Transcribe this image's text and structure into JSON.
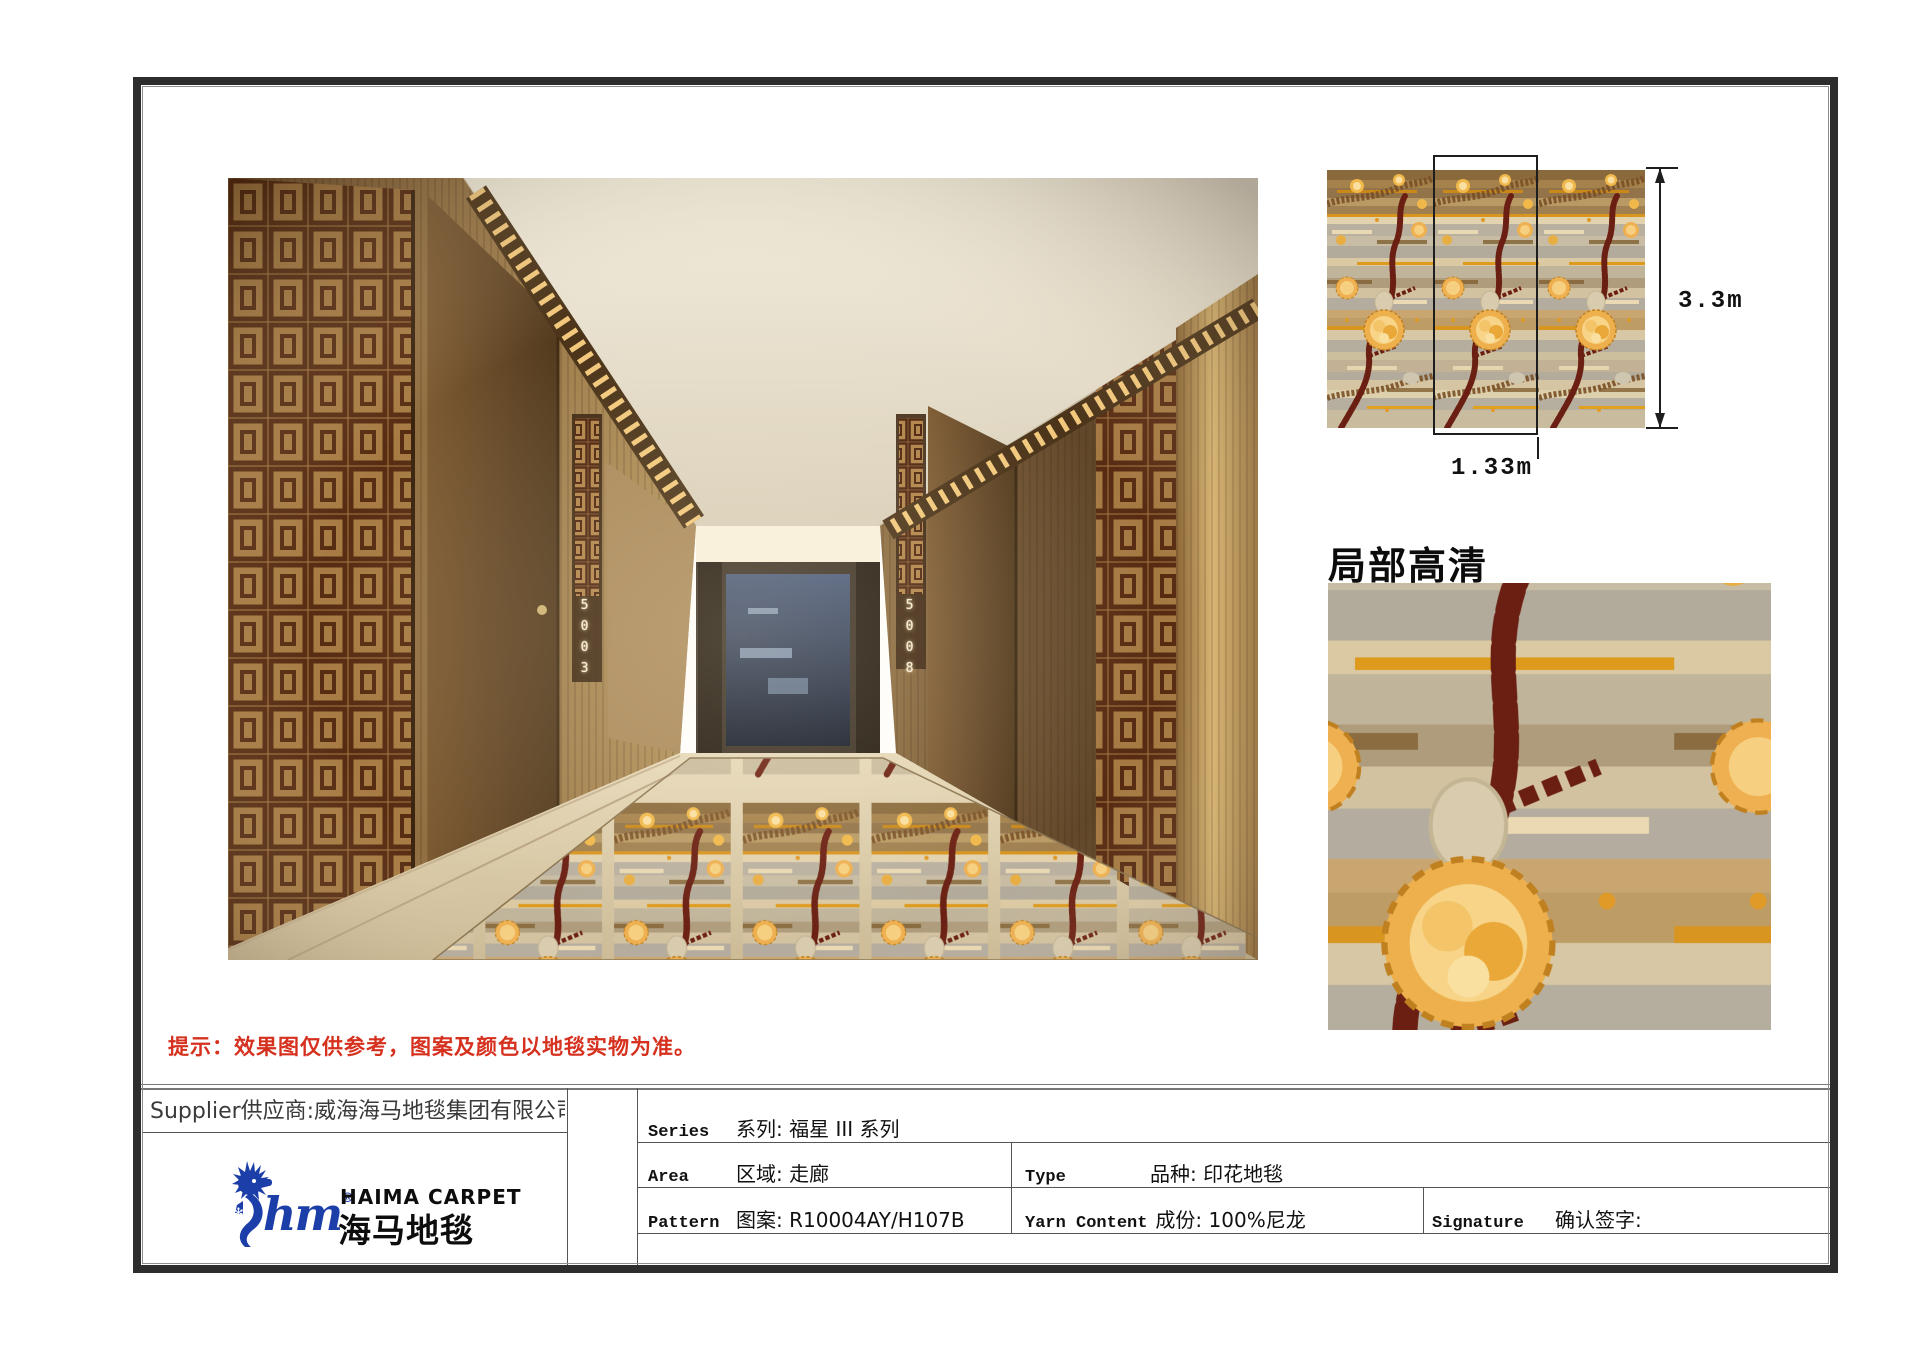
{
  "corridor": {
    "left_door_number": "5003",
    "right_door_number": "5008"
  },
  "swatch": {
    "height_label": "3.3m",
    "width_label": "1.33m"
  },
  "closeup": {
    "title": "局部高清"
  },
  "notice": {
    "text": "提示：效果图仅供参考，图案及颜色以地毯实物为准。",
    "color": "#d6301e"
  },
  "supplier": {
    "text": "Supplier供应商:威海海马地毯集团有限公司"
  },
  "logo": {
    "mark": "hm",
    "reg": "®",
    "name_en": "HAIMA CARPET",
    "name_cn": "海马地毯",
    "color": "#1c3ea8"
  },
  "table": {
    "series": {
      "en": "Series",
      "cn": "系列: 福星 III 系列"
    },
    "area": {
      "en": "Area",
      "cn": "区域: 走廊"
    },
    "pattern": {
      "en": "Pattern",
      "cn": "图案: R10004AY/H107B"
    },
    "type": {
      "en": "Type",
      "cn": "品种: 印花地毯"
    },
    "yarn": {
      "en": "Yarn Content",
      "cn": "成份: 100%尼龙"
    },
    "signature": {
      "en": "Signature",
      "cn": "确认签字:"
    }
  },
  "palette": {
    "carpet_gold": "#edb04c",
    "carpet_maroon": "#6a1f12",
    "carpet_gray": "#b5aea0",
    "carpet_tan": "#a8835a",
    "wood_dark": "#5d4226",
    "wood_light": "#c9a86a",
    "frame": "#2d2d2d"
  }
}
